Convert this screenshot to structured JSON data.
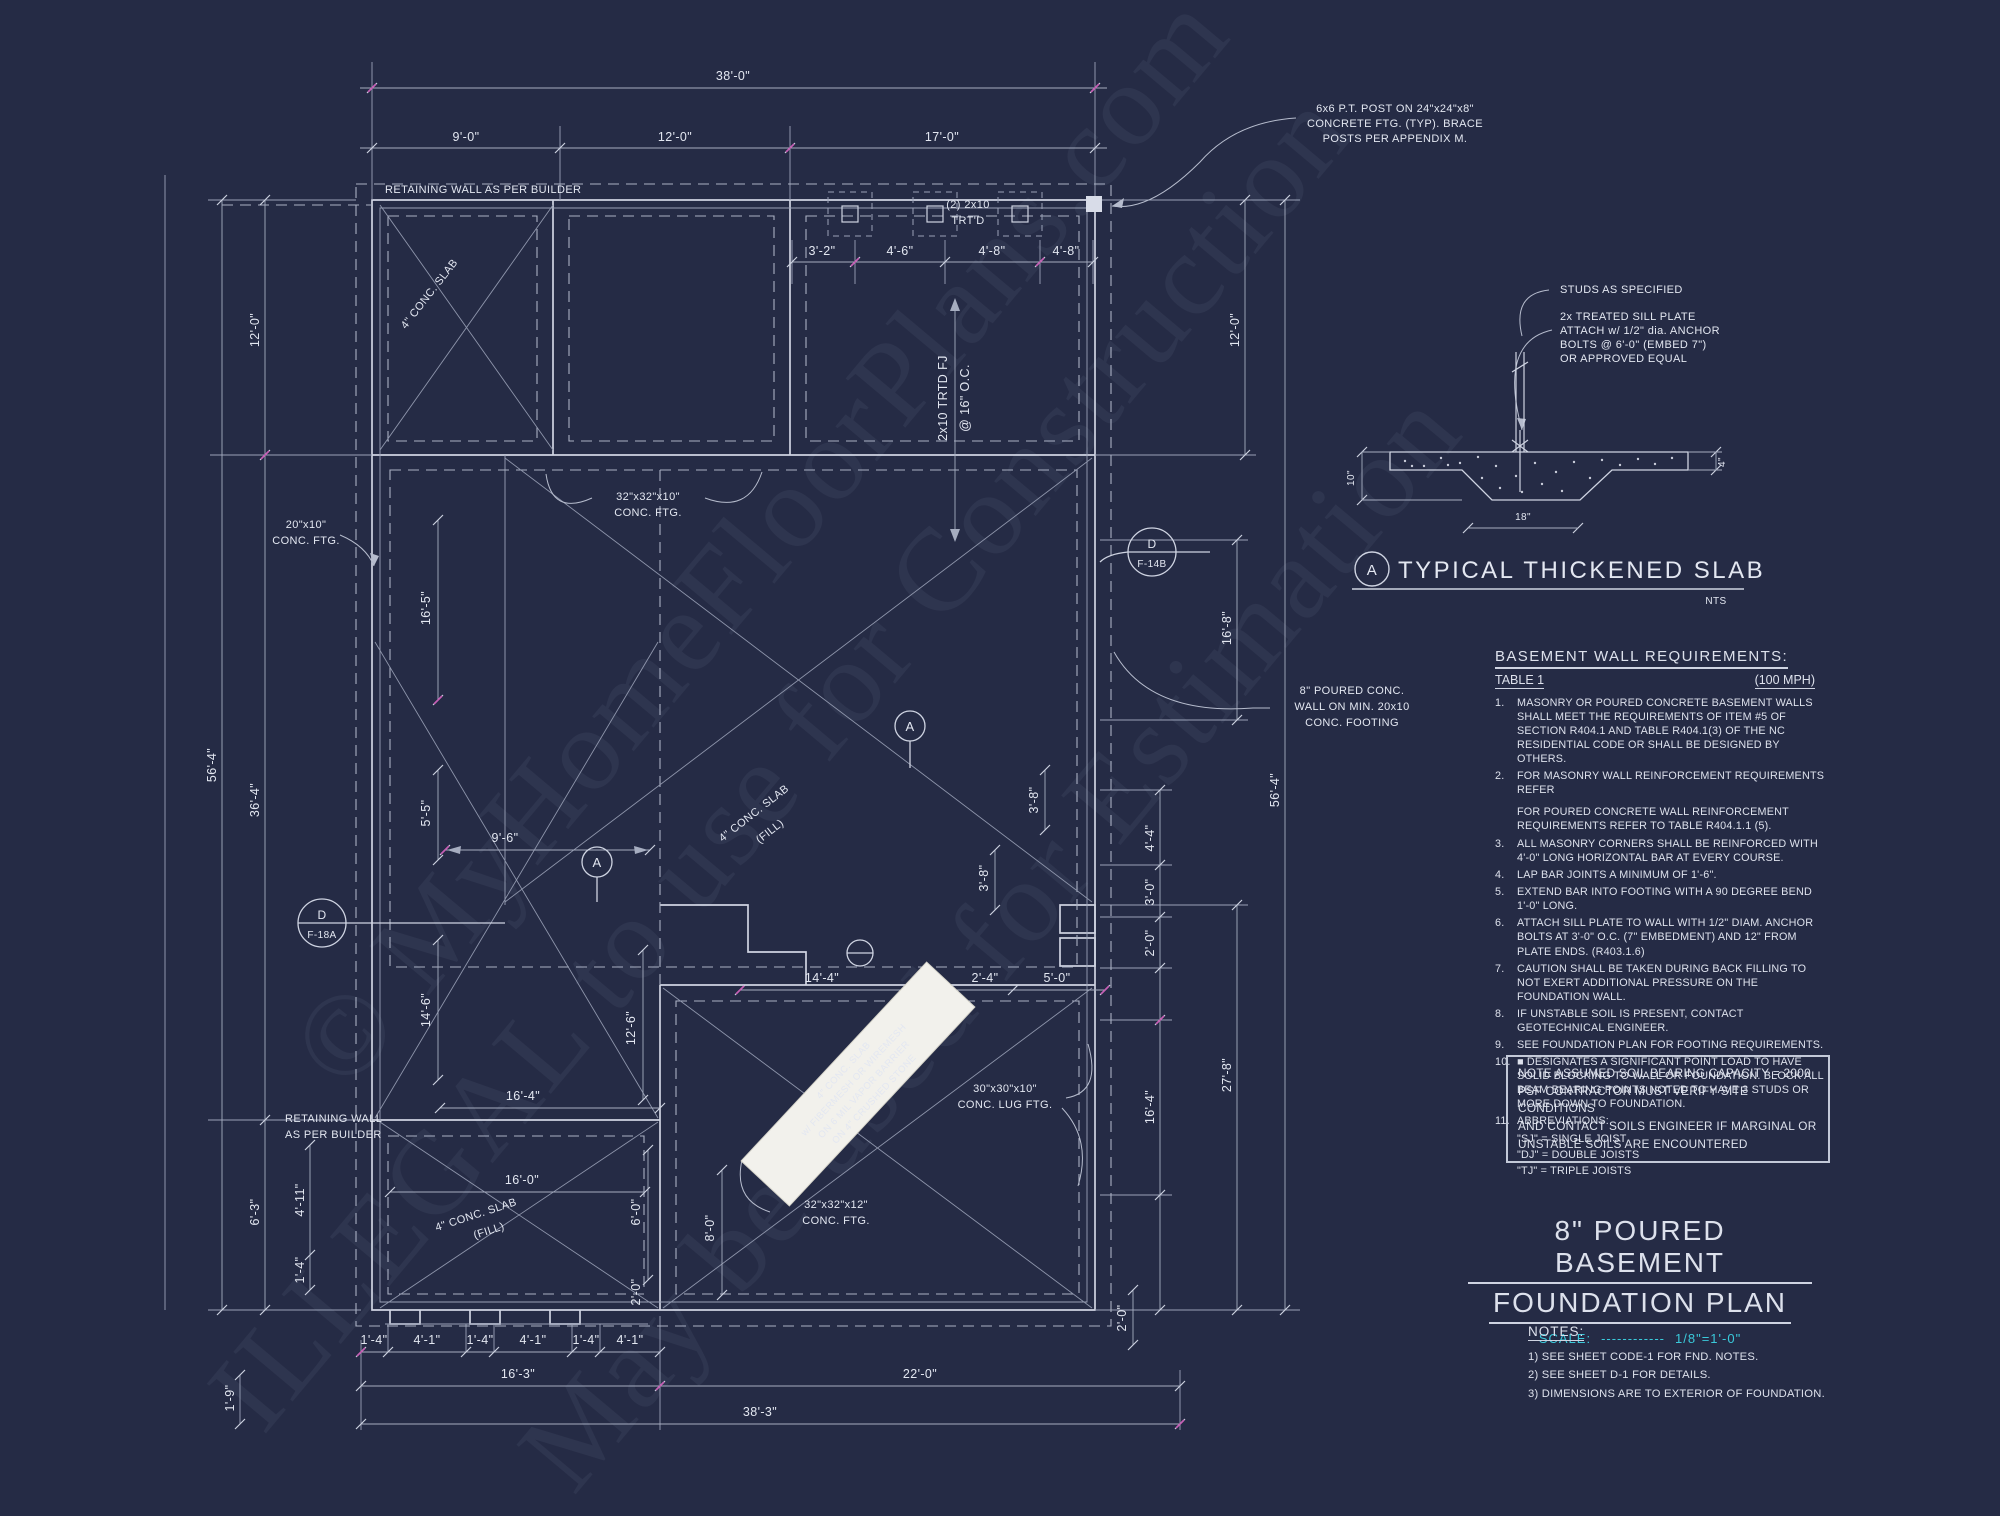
{
  "sheet": {
    "bg": "#252b45",
    "line": "#d7dbe7",
    "cyan": "#3ac9da",
    "magenta": "#c75fb5"
  },
  "watermark": {
    "l1": "© MyHomeFloorPlans.com",
    "l2": "ILLEGAL to use for Construction",
    "l3": "May be used for Estimation"
  },
  "dims": {
    "d38_0": "38'-0\"",
    "d9_0": "9'-0\"",
    "d12_0": "12'-0\"",
    "d17_0": "17'-0\"",
    "d3_2": "3'-2\"",
    "d4_6": "4'-6\"",
    "d4_8": "4'-8\"",
    "d16_5": "16'-5\"",
    "d5_5": "5'-5\"",
    "d9_6": "9'-6\"",
    "d14_6": "14'-6\"",
    "d12_6": "12'-6\"",
    "d16_4": "16'-4\"",
    "d36_4": "36'-4\"",
    "d56_4": "56'-4\"",
    "d16_8": "16'-8\"",
    "d4_4": "4'-4\"",
    "d3_0": "3'-0\"",
    "d2_0": "2'-0\"",
    "d27_8": "27'-8\"",
    "d3_8": "3'-8\"",
    "d14_4": "14'-4\"",
    "d2_4": "2'-4\"",
    "d5_0": "5'-0\"",
    "d16_0": "16'-0\"",
    "d6_0": "6'-0\"",
    "d8_0": "8'-0\"",
    "d6_3": "6'-3\"",
    "d4_11": "4'-11\"",
    "d1_4": "1'-4\"",
    "d4_1": "4'-1\"",
    "d1_9": "1'-9\"",
    "d16_3": "16'-3\"",
    "d22_0": "22'-0\"",
    "d38_3": "38'-3\""
  },
  "plan": {
    "retaining_top": "RETAINING WALL AS PER BUILDER",
    "retaining_1": "RETAINING WALL",
    "retaining_2": "AS PER BUILDER",
    "post_1": "6x6 P.T. POST ON 24\"x24\"x8\"",
    "post_2": "CONCRETE FTG. (TYP). BRACE",
    "post_3": "POSTS PER APPENDIX M.",
    "trtd_1": "(2) 2x10",
    "trtd_2": "TRT'D",
    "fj_1": "2x10 TRTD FJ",
    "fj_2": "@ 16\" O.C.",
    "slab4": "4\" CONC. SLAB",
    "fill": "(FILL)",
    "ftg32_10": "32\"x32\"x10\"",
    "ftg32_12": "32\"x32\"x12\"",
    "ftg20_10": "20\"x10\"",
    "conc_ftg": "CONC. FTG.",
    "lug_1": "30\"x30\"x10\"",
    "lug_2": "CONC. LUG FTG.",
    "wall_1": "8\" POURED CONC.",
    "wall_2": "WALL ON MIN. 20x10",
    "wall_3": "CONC. FOOTING",
    "co_d": "D",
    "co_f14b": "F-14B",
    "co_f18a": "F-18A",
    "co_a": "A",
    "sticker_1": "4\" CONC. SLAB",
    "sticker_2": "w/ FIBERMESH OR WIREMESH",
    "sticker_3": "ON 6 MIL VAPOR BARRIER",
    "sticker_4": "ON 4\" CRUSHED STONE"
  },
  "detail": {
    "studs": "STUDS AS SPECIFIED",
    "sill_1": "2x  TREATED SILL PLATE",
    "sill_2": "ATTACH w/ 1/2\" dia. ANCHOR",
    "sill_3": "BOLTS @ 6'-0\" (EMBED 7\")",
    "sill_4": "OR APPROVED EQUAL",
    "d10": "10\"",
    "d4": "4\"",
    "d18": "18\"",
    "bubble": "A",
    "title": "TYPICAL THICKENED SLAB",
    "nts": "NTS"
  },
  "req": {
    "heading": "BASEMENT WALL REQUIREMENTS:",
    "table": "TABLE 1",
    "mph": "(100 MPH)",
    "items": [
      {
        "n": "1.",
        "t": "MASONRY OR POURED CONCRETE BASEMENT WALLS SHALL MEET THE REQUIREMENTS OF ITEM #5 OF SECTION R404.1 AND TABLE R404.1(3) OF THE NC RESIDENTIAL CODE OR SHALL BE DESIGNED BY OTHERS."
      },
      {
        "n": "2.",
        "t": "FOR MASONRY WALL REINFORCEMENT REQUIREMENTS REFER"
      },
      {
        "n": "3.",
        "t": "ALL MASONRY CORNERS SHALL BE REINFORCED WITH 4'-0\" LONG HORIZONTAL BAR AT EVERY COURSE."
      },
      {
        "n": "4.",
        "t": "LAP BAR JOINTS A MINIMUM OF 1'-6\"."
      },
      {
        "n": "5.",
        "t": "EXTEND BAR INTO FOOTING WITH A 90 DEGREE BEND 1'-0\" LONG."
      },
      {
        "n": "6.",
        "t": "ATTACH SILL PLATE TO WALL WITH 1/2\" DIAM. ANCHOR BOLTS AT 3'-0\" O.C. (7\" EMBEDMENT) AND 12\" FROM PLATE ENDS. (R403.1.6)"
      },
      {
        "n": "7.",
        "t": "CAUTION SHALL BE TAKEN DURING BACK FILLING TO NOT EXERT ADDITIONAL PRESSURE ON THE FOUNDATION WALL."
      },
      {
        "n": "8.",
        "t": "IF UNSTABLE SOIL IS PRESENT, CONTACT GEOTECHNICAL ENGINEER."
      },
      {
        "n": "9.",
        "t": "SEE FOUNDATION PLAN FOR FOOTING REQUIREMENTS."
      },
      {
        "n": "10.",
        "t": "■ DESIGNATES A SIGNIFICANT POINT LOAD TO HAVE SOLID BLOCKING TO WALL OR FOUNDATION.  BLOCK ALL BEAM BEARING POINTS NOTED TO HAVE 3 STUDS OR MORE DOWN TO FOUNDATION."
      },
      {
        "n": "11.",
        "t": "ABBREVIATIONS:"
      }
    ],
    "item2b": "FOR POURED CONCRETE WALL REINFORCEMENT REQUIREMENTS REFER TO TABLE R404.1.1 (5).",
    "abbr_1": "\"SJ\" = SINGLE JOIST",
    "abbr_2": "\"DJ\" = DOUBLE JOISTS",
    "abbr_3": "\"TJ\" = TRIPLE JOISTS"
  },
  "soil": {
    "l1": "NOTE ASSUMED SOIL BEARING CAPACITY = 2000",
    "l2": "PSF CONTRACTOR MUST VERIFY SITE CONDITIONS",
    "l3": "AND CONTACT SOILS ENGINEER IF MARGINAL OR",
    "l4": "UNSTABLE SOILS ARE ENCOUNTERED"
  },
  "title_block": {
    "l1": "8\" POURED BASEMENT",
    "l2": "FOUNDATION PLAN",
    "scale_label": "SCALE:",
    "scale_dashes": "------------",
    "scale_value": "1/8\"=1'-0\""
  },
  "notes": {
    "heading": "NOTES:",
    "n1": "1)  SEE SHEET CODE-1 FOR FND. NOTES.",
    "n2": "2)  SEE SHEET D-1 FOR DETAILS.",
    "n3": "3)  DIMENSIONS ARE TO EXTERIOR OF FOUNDATION."
  }
}
